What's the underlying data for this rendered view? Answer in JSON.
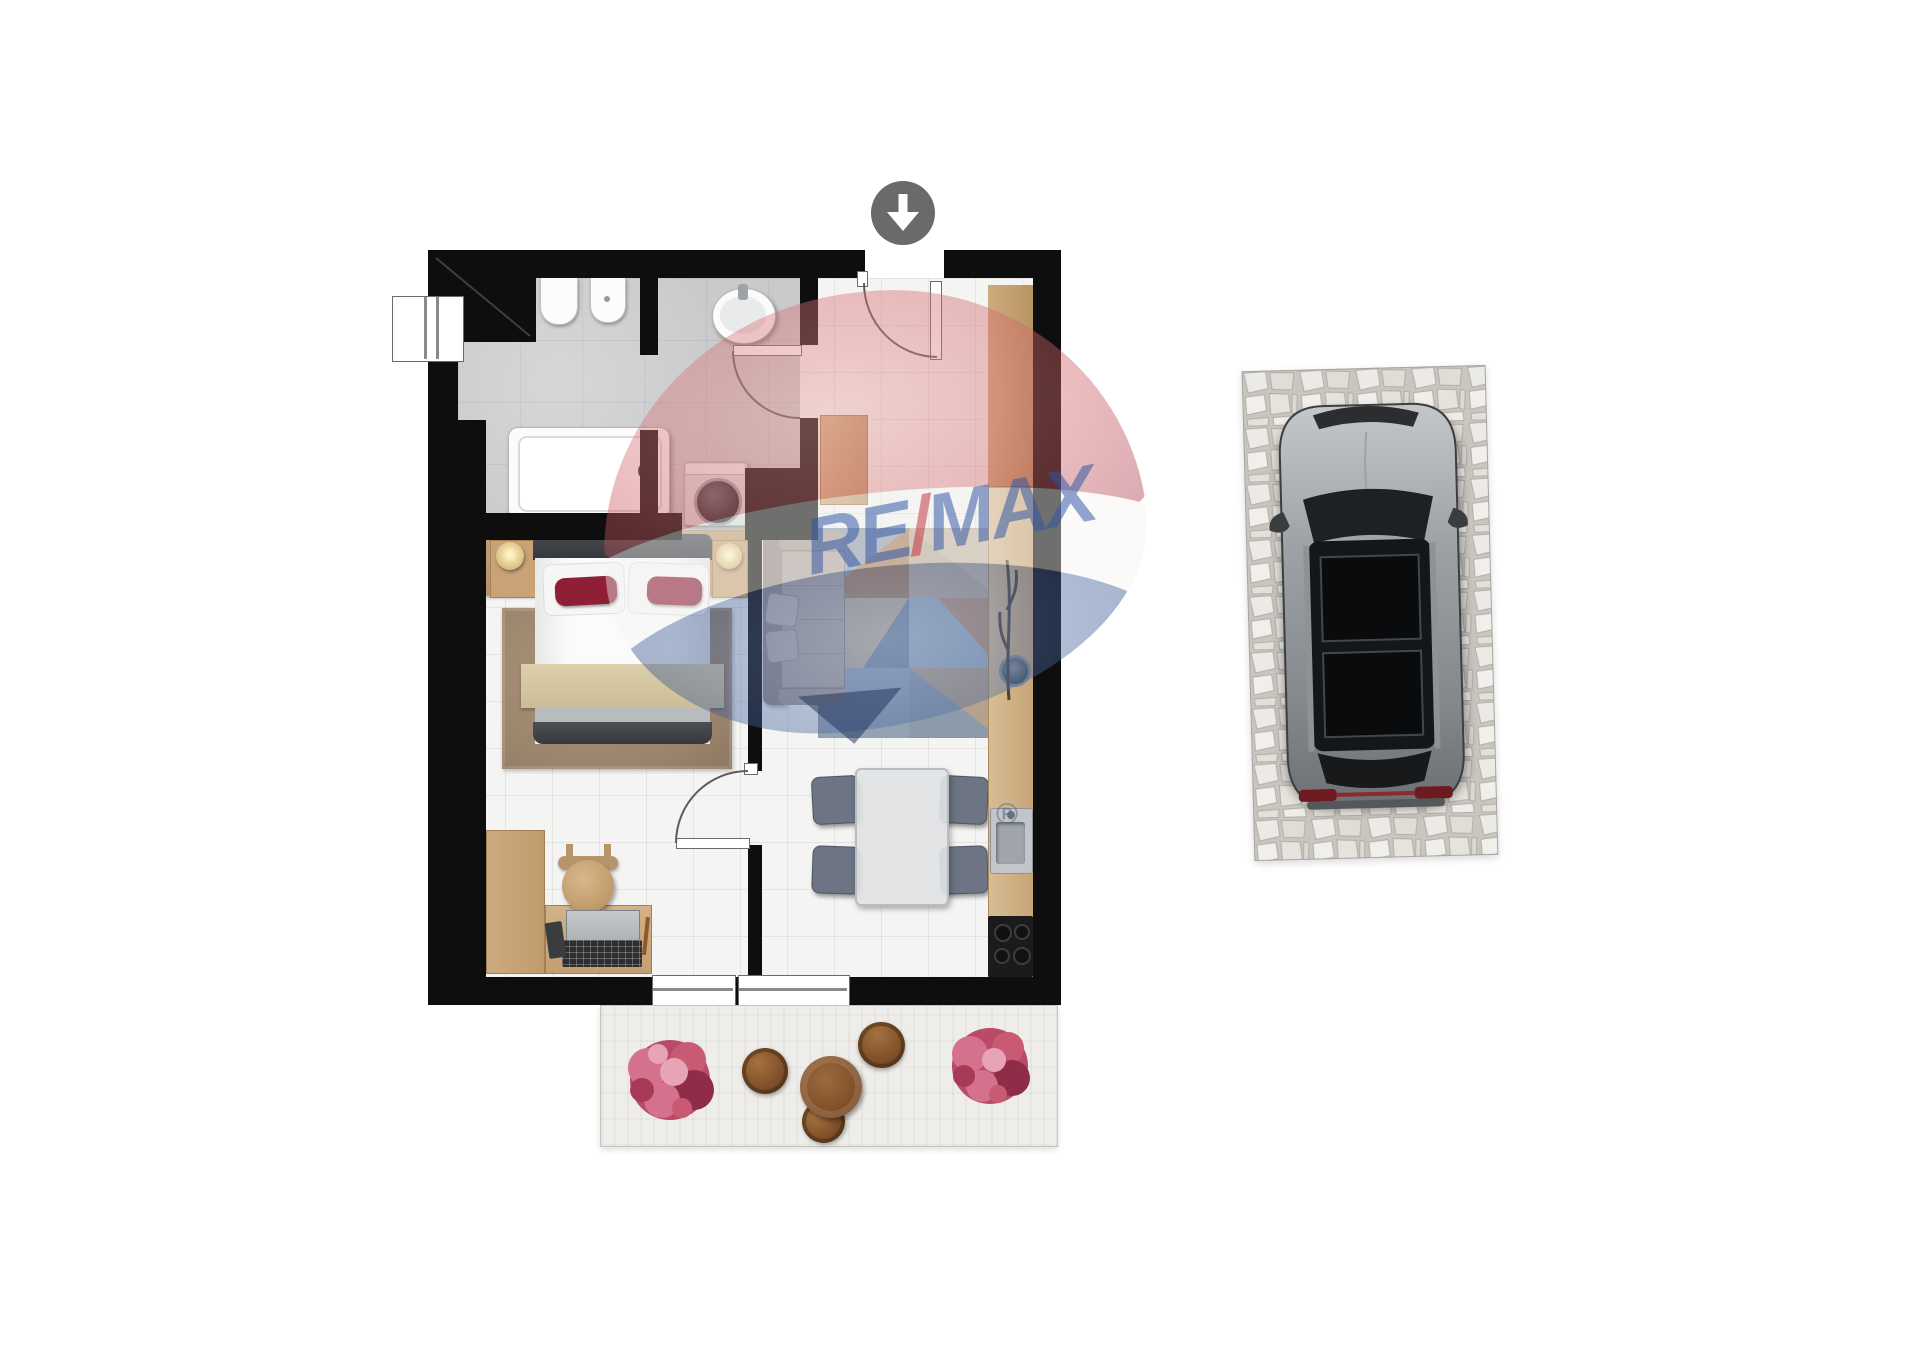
{
  "watermark": {
    "text_re": "RE",
    "text_slash": "/",
    "text_max": "MAX",
    "registered": "®",
    "text_color": "#2f55a4",
    "slash_color": "#c4303a",
    "balloon_red": "#c9565f",
    "balloon_white": "#f5f3f2",
    "balloon_blue": "#27407c"
  },
  "entry": {
    "icon": "arrow-down-icon",
    "circle_color": "#6a6a6a"
  },
  "palette": {
    "wall": "#0e0e0e",
    "bathroom_floor": "#c8cacb",
    "tile_floor": "#f4f4f3",
    "wood": "#c9a377",
    "bedroom_rug": "#a28b72",
    "bed_accent_red": "#8e1f35",
    "sofa": "#a39791",
    "dining_chair": "#6d7585",
    "terrace_plant_pink": "#c85a74",
    "car_body": "#9aa0a4",
    "car_roof": "#141619",
    "taillight_red": "#6e1b1f"
  }
}
